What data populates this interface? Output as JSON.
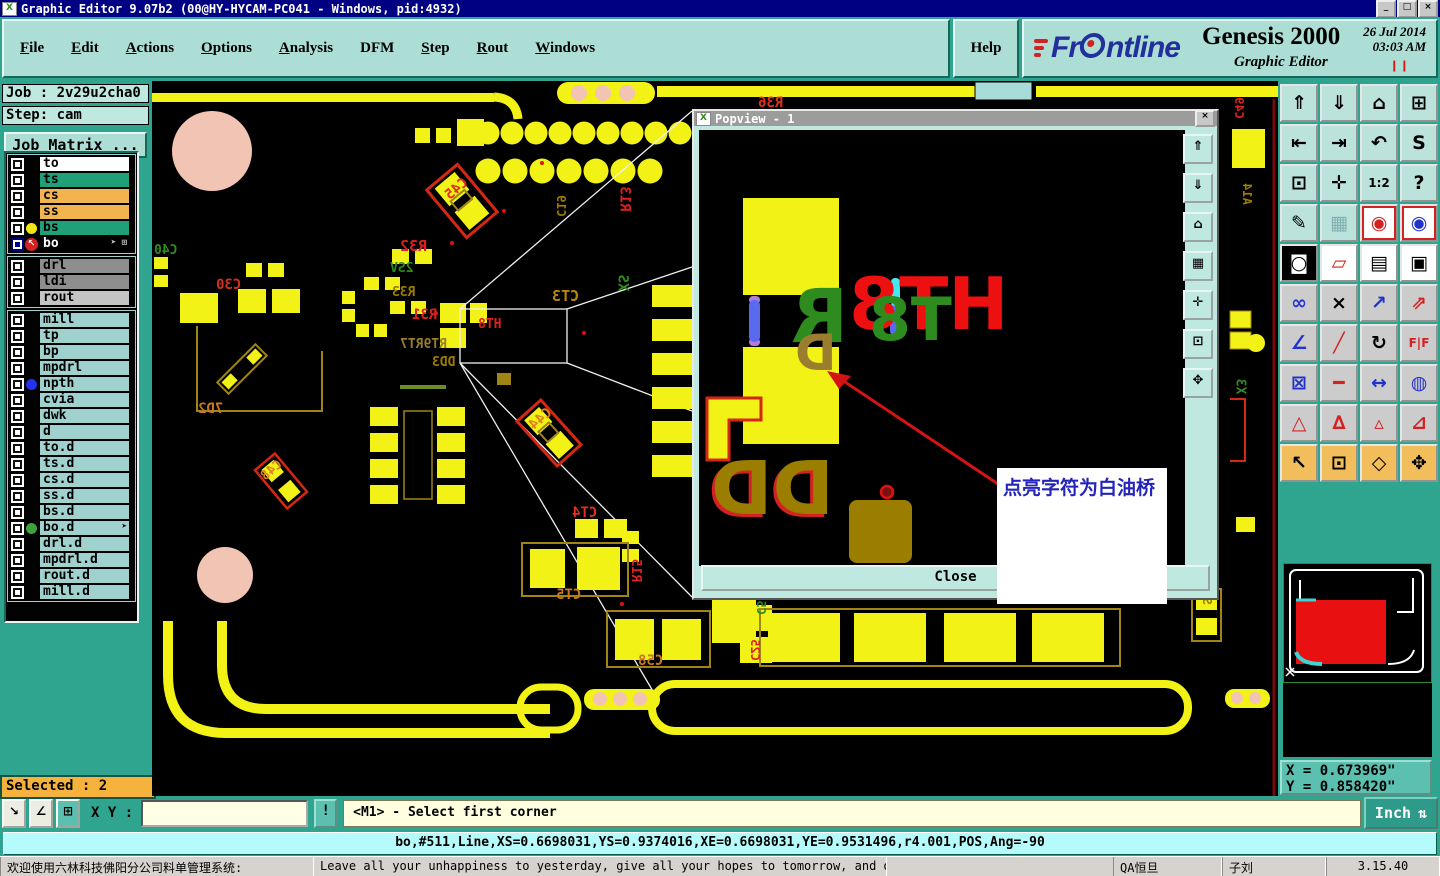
{
  "colors": {
    "window_face": "#2FA48E",
    "panel_face": "#ACDED6",
    "canvas_bg": "#000000",
    "pad_yellow": "#F2F216",
    "status_cyan": "#B6FBFB",
    "selected_orange": "#F5B23C",
    "message_yellow": "#FFFFE0",
    "title_blue": "#000082"
  },
  "title_bar": {
    "title": "Graphic Editor 9.07b2 (00@HY-HYCAM-PC041 - Windows, pid:4932)",
    "icon_glyph": "X",
    "buttons": [
      "_",
      "□",
      "×"
    ]
  },
  "menu_bar": {
    "items": [
      {
        "label": "File",
        "u": 0
      },
      {
        "label": "Edit",
        "u": 0
      },
      {
        "label": "Actions",
        "u": 0
      },
      {
        "label": "Options",
        "u": 0
      },
      {
        "label": "Analysis",
        "u": 0
      },
      {
        "label": "DFM",
        "u": -1
      },
      {
        "label": "Step",
        "u": 0
      },
      {
        "label": "Rout",
        "u": 0
      },
      {
        "label": "Windows",
        "u": 0
      }
    ],
    "help_label": "Help"
  },
  "brand": {
    "logo_pre": "Fr",
    "logo_post": "ntline",
    "product": "Genesis 2000",
    "subtitle": "Graphic Editor",
    "date": "26 Jul 2014",
    "time": "03:03 AM",
    "pause_glyph": "❙❙"
  },
  "sidebar": {
    "job_label": "Job : 2v29u2cha0",
    "step_label": "Step: cam",
    "job_matrix_button": "Job Matrix ...",
    "selected_label": "Selected : 2",
    "layer_groups": [
      [
        {
          "name": "to",
          "bg": "#FFFFFF",
          "fg": "#000000"
        },
        {
          "name": "ts",
          "bg": "#20A078",
          "fg": "#000000"
        },
        {
          "name": "cs",
          "bg": "#F2B44E",
          "fg": "#000000"
        },
        {
          "name": "ss",
          "bg": "#F2B44E",
          "fg": "#000000"
        },
        {
          "name": "bs",
          "bg": "#20A078",
          "fg": "#000000",
          "dot": "#F2E716"
        },
        {
          "name": "bo",
          "bg": "#000000",
          "fg": "#FFFFFF",
          "cb": "navy",
          "work": true,
          "extras": "➤ ⊞"
        }
      ],
      [
        {
          "name": "drl",
          "bg": "#8E8E8E",
          "fg": "#000000"
        },
        {
          "name": "ldi",
          "bg": "#8E8E8E",
          "fg": "#000000"
        },
        {
          "name": "rout",
          "bg": "#C4C4C4",
          "fg": "#000000"
        }
      ],
      [
        {
          "name": "mill",
          "bg": "#9FD2CE",
          "fg": "#000000"
        },
        {
          "name": "tp",
          "bg": "#9FD2CE",
          "fg": "#000000"
        },
        {
          "name": "bp",
          "bg": "#9FD2CE",
          "fg": "#000000"
        },
        {
          "name": "mpdrl",
          "bg": "#9FD2CE",
          "fg": "#000000"
        },
        {
          "name": "npth",
          "bg": "#9FD2CE",
          "fg": "#000000",
          "dot": "#2233EE"
        },
        {
          "name": "cvia",
          "bg": "#9FD2CE",
          "fg": "#000000"
        },
        {
          "name": "dwk",
          "bg": "#9FD2CE",
          "fg": "#000000"
        },
        {
          "name": "d",
          "bg": "#9FD2CE",
          "fg": "#000000"
        },
        {
          "name": "to.d",
          "bg": "#9FD2CE",
          "fg": "#000000"
        },
        {
          "name": "ts.d",
          "bg": "#9FD2CE",
          "fg": "#000000"
        },
        {
          "name": "cs.d",
          "bg": "#9FD2CE",
          "fg": "#000000"
        },
        {
          "name": "ss.d",
          "bg": "#9FD2CE",
          "fg": "#000000"
        },
        {
          "name": "bs.d",
          "bg": "#9FD2CE",
          "fg": "#000000"
        },
        {
          "name": "bo.d",
          "bg": "#9FD2CE",
          "fg": "#000000",
          "dot": "#3FA03F",
          "extras": "➤"
        },
        {
          "name": "drl.d",
          "bg": "#9FD2CE",
          "fg": "#000000"
        },
        {
          "name": "mpdrl.d",
          "bg": "#9FD2CE",
          "fg": "#000000"
        },
        {
          "name": "rout.d",
          "bg": "#9FD2CE",
          "fg": "#000000"
        },
        {
          "name": "mill.d",
          "bg": "#9FD2CE",
          "fg": "#000000"
        }
      ]
    ]
  },
  "popview": {
    "title": "Popview - 1",
    "close_button": "Close",
    "x_button": "×",
    "icon_glyph": "X",
    "annotation": "点亮字符为白油桥",
    "side_buttons": [
      {
        "n": "pv-copy-up",
        "g": "⇑"
      },
      {
        "n": "pv-copy-down",
        "g": "⇓"
      },
      {
        "n": "pv-home",
        "g": "⌂"
      },
      {
        "n": "pv-grid",
        "g": "▦"
      },
      {
        "n": "pv-center",
        "g": "✛"
      },
      {
        "n": "pv-zoom-box",
        "g": "⊡"
      },
      {
        "n": "pv-pan",
        "g": "✥"
      }
    ],
    "art": [
      {
        "t": "R",
        "x": 92,
        "y": 150,
        "c": "#2E8B1E",
        "fs": 74
      },
      {
        "t": "D",
        "x": 96,
        "y": 198,
        "c": "#9B7D2E",
        "fs": 50
      },
      {
        "t": "HT8",
        "x": 150,
        "y": 138,
        "c": "#EE1010",
        "fs": 72
      },
      {
        "t": "T8",
        "x": 170,
        "y": 160,
        "c": "#2E8B1E",
        "fs": 60
      },
      {
        "t": "DD",
        "x": 12,
        "y": 322,
        "c": "#9B7D00",
        "fs": 74,
        "sh": "#D42222"
      }
    ]
  },
  "right_toolbar": {
    "buttons": [
      {
        "n": "view-copy-up",
        "g": "⇑",
        "bg": "#BCE2DC"
      },
      {
        "n": "view-copy-down",
        "g": "⇓",
        "bg": "#BCE2DC"
      },
      {
        "n": "home-view",
        "g": "⌂",
        "bg": "#BCE2DC"
      },
      {
        "n": "tile-windows-xy",
        "g": "⊞",
        "bg": "#BCE2DC"
      },
      {
        "n": "pan-left",
        "g": "⇤",
        "bg": "#BCE2DC"
      },
      {
        "n": "pan-right",
        "g": "⇥",
        "bg": "#BCE2DC"
      },
      {
        "n": "previous-view",
        "g": "↶",
        "bg": "#BCE2DC"
      },
      {
        "n": "serpentine-view",
        "g": "S",
        "bg": "#BCE2DC"
      },
      {
        "n": "zoom-margins",
        "g": "⊡",
        "bg": "#BCE2DC"
      },
      {
        "n": "pan-center",
        "g": "✛",
        "bg": "#BCE2DC"
      },
      {
        "n": "scale-1-2",
        "g": "1:2",
        "bg": "#BCE2DC",
        "sm": 1
      },
      {
        "n": "context-help",
        "g": "?",
        "bg": "#BCE2DC"
      },
      {
        "n": "setup-editor",
        "g": "✎",
        "bg": "#BCE2DC"
      },
      {
        "n": "snap-grid",
        "g": "▦",
        "bg": "#BCE2DC",
        "fg": "#7FB0B0"
      },
      {
        "n": "net-view-a",
        "g": "◉",
        "bg": "#FFFFFF",
        "fg": "#D42222",
        "bd": "#D42222"
      },
      {
        "n": "net-view-b",
        "g": "◉",
        "bg": "#FFFFFF",
        "fg": "#2233CC",
        "bd": "#D42222"
      },
      {
        "n": "inverse-video",
        "g": "◙",
        "bg": "#000000",
        "fg": "#FFFFFF"
      },
      {
        "n": "reshape",
        "g": "▱",
        "bg": "#FFFFFF",
        "fg": "#D42222"
      },
      {
        "n": "ruler",
        "g": "▤",
        "bg": "#FFFFFF"
      },
      {
        "n": "pad-display",
        "g": "▣",
        "bg": "#FFFFFF"
      },
      {
        "n": "chain-select",
        "g": "∞",
        "bg": "#CCCCCC",
        "fg": "#2233CC"
      },
      {
        "n": "delete-element",
        "g": "×",
        "bg": "#CCCCCC"
      },
      {
        "n": "copy-element",
        "g": "↗",
        "bg": "#CCCCCC",
        "fg": "#2233CC"
      },
      {
        "n": "move-element",
        "g": "⇗",
        "bg": "#CCCCCC",
        "fg": "#D42222"
      },
      {
        "n": "measure-angle",
        "g": "∠",
        "bg": "#CCCCCC",
        "fg": "#2233CC"
      },
      {
        "n": "slope-line",
        "g": "╱",
        "bg": "#CCCCCC",
        "fg": "#D42222"
      },
      {
        "n": "rotate",
        "g": "↻",
        "bg": "#CCCCCC"
      },
      {
        "n": "mirror",
        "g": "F|F",
        "bg": "#CCCCCC",
        "fg": "#D42222",
        "sm": 1
      },
      {
        "n": "swap-pads",
        "g": "⊠",
        "bg": "#CCCCCC",
        "fg": "#2233CC"
      },
      {
        "n": "break-line",
        "g": "━",
        "bg": "#CCCCCC",
        "fg": "#D42222"
      },
      {
        "n": "measure-distance",
        "g": "↔",
        "bg": "#CCCCCC",
        "fg": "#2233CC"
      },
      {
        "n": "merge-shapes",
        "g": "◍",
        "bg": "#CCCCCC",
        "fg": "#2233CC"
      },
      {
        "n": "arc-mode-1",
        "g": "△",
        "bg": "#CCCCCC",
        "fg": "#D42222"
      },
      {
        "n": "arc-mode-2",
        "g": "∆",
        "bg": "#CCCCCC",
        "fg": "#D42222"
      },
      {
        "n": "arc-mode-3",
        "g": "▵",
        "bg": "#CCCCCC",
        "fg": "#D42222"
      },
      {
        "n": "arc-mode-4",
        "g": "⊿",
        "bg": "#CCCCCC",
        "fg": "#D42222"
      },
      {
        "n": "select-single",
        "g": "↖",
        "bg": "#F2BE5C"
      },
      {
        "n": "select-window",
        "g": "⊡",
        "bg": "#F2BE5C"
      },
      {
        "n": "select-polygon",
        "g": "◇",
        "bg": "#F2BE5C"
      },
      {
        "n": "select-reference",
        "g": "✥",
        "bg": "#F2BE5C"
      }
    ]
  },
  "coords": {
    "x": "X = 0.673969\"",
    "y": "Y = 0.858420\""
  },
  "bottom_bar": {
    "small_buttons": [
      {
        "n": "pointer-mode",
        "g": "↘"
      },
      {
        "n": "angle-mode",
        "g": "∠"
      },
      {
        "n": "grid-mode",
        "g": "⊞",
        "teal": 1
      }
    ],
    "xy_label": "X Y :",
    "xy_value": "",
    "alert_button": "!",
    "message": "<M1> - Select first corner",
    "unit_button": "Inch",
    "unit_icon": "⇅"
  },
  "status_line": "bo,#511,Line,XS=0.6698031,YS=0.9374016,XE=0.6698031,YE=0.9531496,r4.001,POS,Ang=-90",
  "taskbar": {
    "app_title": "欢迎使用六林科技佛阳分公司料单管理系统:",
    "quote": "Leave all your unhappiness to yesterday, give all your hopes to tomorrow, and do all your hard work today.",
    "segments": [
      "QA恒旦",
      "子刘",
      "3.15.40"
    ]
  },
  "canvas": {
    "labels": [
      {
        "t": "R36",
        "x": 606,
        "y": 14,
        "c": "#E03020"
      },
      {
        "t": "C45",
        "x": 292,
        "y": 100,
        "c": "#E03020",
        "r": -40
      },
      {
        "t": "C40",
        "x": 2,
        "y": 162,
        "c": "#2E8B1E",
        "fs": 13
      },
      {
        "t": "C30",
        "x": 64,
        "y": 196,
        "c": "#D03020"
      },
      {
        "t": "R32",
        "x": 248,
        "y": 156,
        "c": "#E02020",
        "fs": 15
      },
      {
        "t": "2SV",
        "x": 238,
        "y": 180,
        "c": "#2E8B1E",
        "fs": 13
      },
      {
        "t": "R33",
        "x": 240,
        "y": 204,
        "c": "#9B7D00",
        "fs": 13
      },
      {
        "t": "R31",
        "x": 260,
        "y": 226,
        "c": "#E02020"
      },
      {
        "t": "CT3",
        "x": 400,
        "y": 206,
        "c": "#B8860B",
        "fs": 15
      },
      {
        "t": "C19",
        "x": 398,
        "y": 118,
        "c": "#9B7D00",
        "fs": 12,
        "r": 90
      },
      {
        "t": "R13",
        "x": 460,
        "y": 110,
        "c": "#E02020",
        "r": 90
      },
      {
        "t": "XS",
        "x": 462,
        "y": 194,
        "c": "#2E8B1E",
        "r": 90
      },
      {
        "t": "HT8",
        "x": 326,
        "y": 236,
        "c": "#E02020",
        "fs": 13
      },
      {
        "t": "RT9RT7",
        "x": 248,
        "y": 256,
        "c": "#9B7D2E",
        "fs": 13
      },
      {
        "t": "DD3",
        "x": 280,
        "y": 274,
        "c": "#9B7D00",
        "fs": 13
      },
      {
        "t": "7D2",
        "x": 46,
        "y": 320,
        "c": "#C87820"
      },
      {
        "t": "C44",
        "x": 376,
        "y": 330,
        "c": "#E08020",
        "r": -40
      },
      {
        "t": "C48",
        "x": 108,
        "y": 382,
        "c": "#E08020",
        "fs": 13,
        "r": -40
      },
      {
        "t": "CT4",
        "x": 420,
        "y": 424,
        "c": "#E03020"
      },
      {
        "t": "R15",
        "x": 472,
        "y": 482,
        "c": "#E02020",
        "fs": 13,
        "r": 90
      },
      {
        "t": "CT5",
        "x": 404,
        "y": 506,
        "c": "#C87820"
      },
      {
        "t": "C58",
        "x": 486,
        "y": 572,
        "c": "#C87820"
      },
      {
        "t": "C57",
        "x": 598,
        "y": 516,
        "c": "#2E8B1E",
        "fs": 12,
        "r": 90
      },
      {
        "t": "C25",
        "x": 592,
        "y": 562,
        "c": "#E02020",
        "fs": 12,
        "r": 90
      },
      {
        "t": "C49",
        "x": 1076,
        "y": 20,
        "c": "#E02020",
        "fs": 12,
        "r": 90
      },
      {
        "t": "A14",
        "x": 1084,
        "y": 106,
        "c": "#9B7D00",
        "fs": 12,
        "r": 90
      },
      {
        "t": "X3",
        "x": 1080,
        "y": 298,
        "c": "#2E8B1E",
        "fs": 13,
        "r": 90
      },
      {
        "t": "SD2",
        "x": 1044,
        "y": 506,
        "c": "#9B7D00",
        "fs": 12,
        "r": 90
      }
    ]
  }
}
